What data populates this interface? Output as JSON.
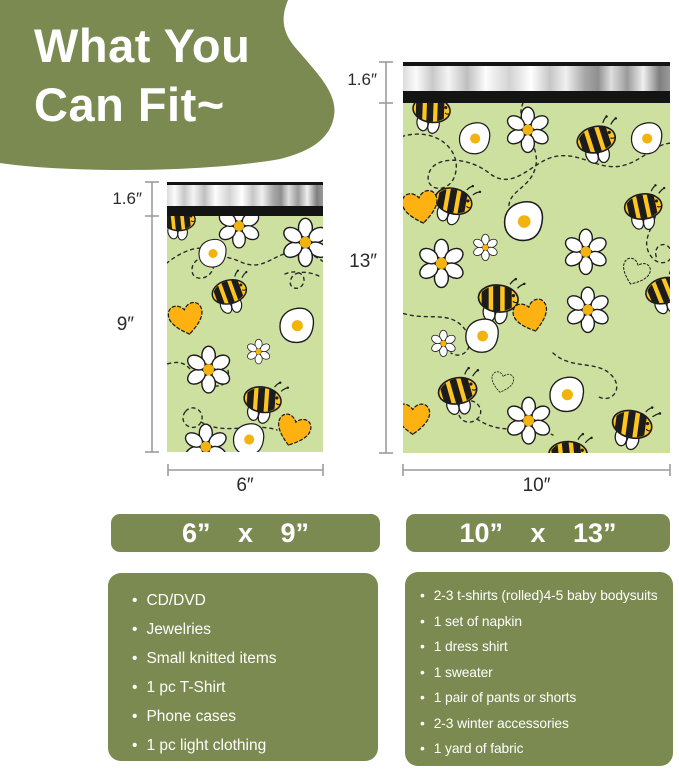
{
  "title": {
    "line1": "What You",
    "line2": "Can Fit~"
  },
  "colors": {
    "olive_green": "#7b8a50",
    "bag_green": "#cde0a0",
    "bee_yellow": "#fec521",
    "heart_yellow": "#feb211",
    "flower_center_yellow": "#f2b30d",
    "flap_black": "#141414",
    "dimension_line_gray": "#9c9c9c",
    "text_white": "#ffffff"
  },
  "pattern_motifs": [
    "bee-icon",
    "daisy-icon",
    "fried-egg-icon",
    "heart-icon",
    "dashed-flight-path"
  ],
  "small_bag": {
    "flap_height_label": "1.6″",
    "body_height_label": "9″",
    "width_label": "6″",
    "size_button": "6” x 9”",
    "fits": [
      "CD/DVD",
      "Jewelries",
      "Small knitted items",
      "1 pc T-Shirt",
      "Phone cases",
      "1 pc light clothing"
    ]
  },
  "large_bag": {
    "flap_height_label": "1.6″",
    "body_height_label": "13″",
    "width_label": "10″",
    "size_button": "10” x 13”",
    "fits": [
      "2-3 t-shirts (rolled)4-5 baby bodysuits",
      "1 set of napkin",
      "1 dress shirt",
      "1 sweater",
      "1 pair of pants or shorts",
      "2-3 winter accessories",
      "1 yard of fabric"
    ]
  }
}
